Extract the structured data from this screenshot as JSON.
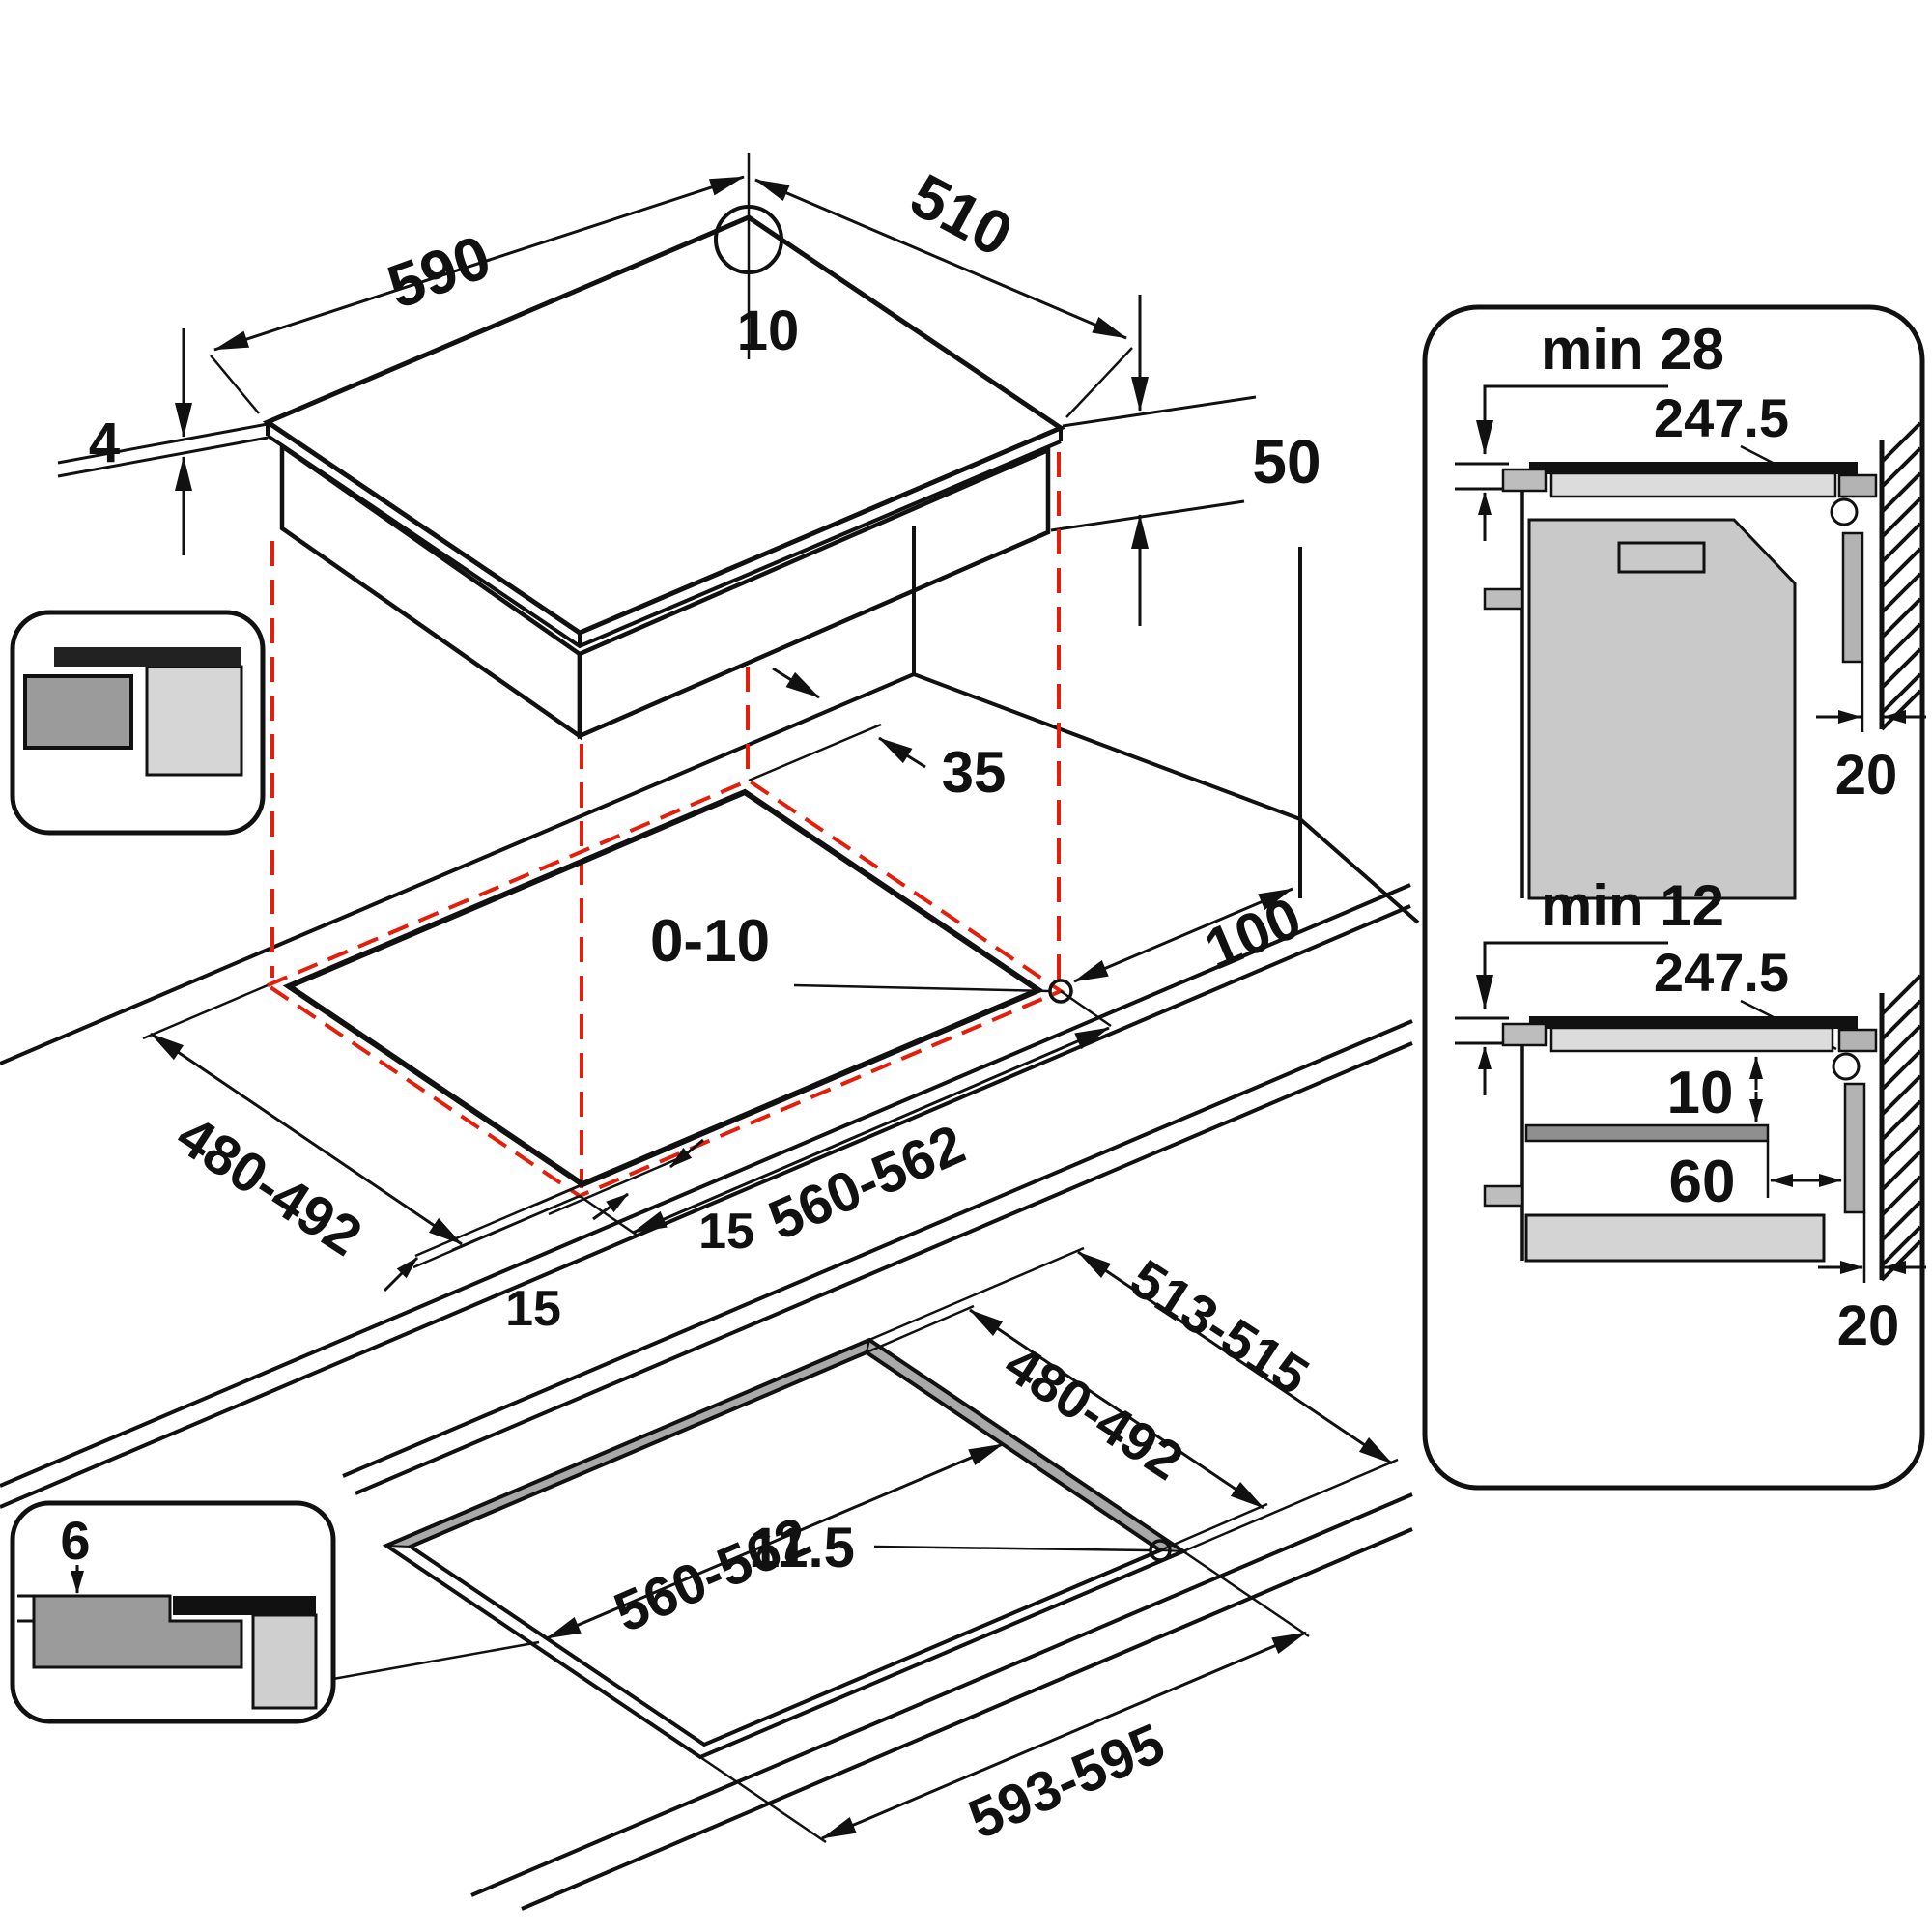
{
  "colors": {
    "line": "#111111",
    "accent_red": "#e31e0a"
  },
  "top_view": {
    "width": "590",
    "depth": "510",
    "center_hole": "10",
    "glass_thickness": "4",
    "body_height": "50"
  },
  "middle_view": {
    "wall_clearance_back": "35",
    "corner_radius_range": "0-10",
    "cutout_depth_range": "480-492",
    "side_margin_left": "15",
    "side_margin_right": "15",
    "cutout_width_range": "560-562",
    "wall_clearance_right": "100"
  },
  "bottom_view": {
    "recess_depth": "6",
    "recess_outer_depth_range": "513-515",
    "cutout_depth_range": "480-492",
    "cutout_width_range": "560-562",
    "corner_radius": "11.5",
    "recess_outer_width_range": "593-595"
  },
  "section_min28": {
    "title": "min 28",
    "hole_center_distance": "247.5",
    "wall_gap": "20"
  },
  "section_min12": {
    "title": "min 12",
    "hole_center_distance": "247.5",
    "under_clearance": "10",
    "shelf_setback": "60",
    "wall_gap": "20"
  }
}
